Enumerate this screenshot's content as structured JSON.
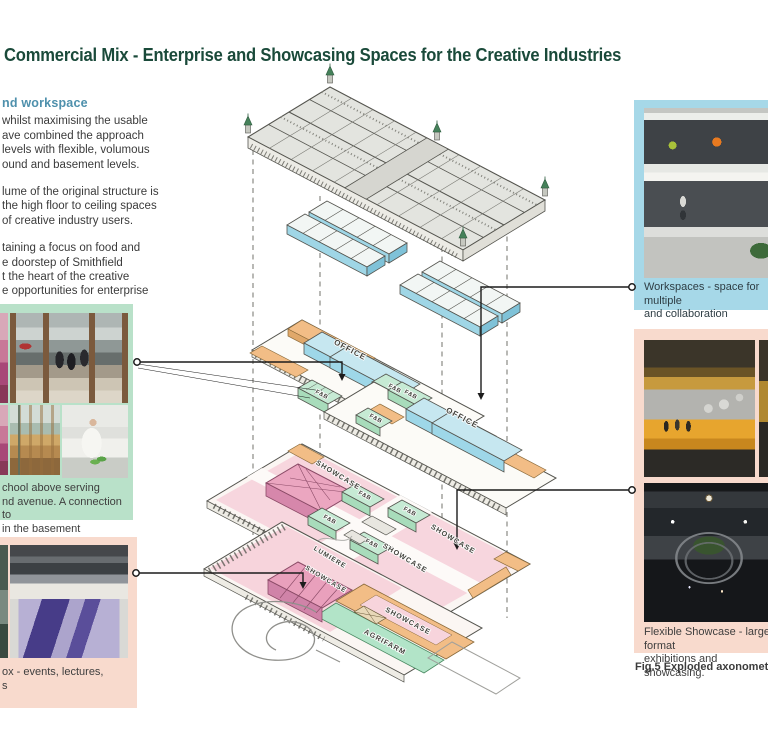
{
  "title": {
    "text": "Commercial Mix - Enterprise and Showcasing Spaces for the Creative Industries",
    "color": "#1a4a3a"
  },
  "left_column": {
    "heading": "nd workspace",
    "heading_color": "#4e90ac",
    "paragraphs": [
      {
        "lines": [
          "whilst maximising the usable",
          "ave combined the approach",
          "levels with flexible, volumous",
          "ound and basement levels."
        ]
      },
      {
        "lines": [
          "lume of the original structure is",
          "the high floor to ceiling spaces",
          "of creative industry users."
        ]
      },
      {
        "lines": [
          "taining a focus on food and",
          "e doorstep of Smithfield",
          "t the heart of the creative",
          "e opportunities for enterprise"
        ]
      }
    ]
  },
  "panels": {
    "food_school": {
      "bg": "#b9e1c9",
      "caption_lines": [
        "chool above serving",
        "nd avenue. A connection to",
        "in the basement"
      ]
    },
    "events_box": {
      "bg": "#f8dacd",
      "caption_lines": [
        "ox - events, lectures,",
        "s"
      ]
    },
    "workspaces": {
      "bg": "#a6d8e8",
      "caption_lines": [
        "Workspaces - space for multiple",
        "and collaboration"
      ]
    },
    "flexible_showcase": {
      "bg": "#f8dacd",
      "caption_lines": [
        "Flexible Showcase - large format",
        "exhibitions and showcasing."
      ]
    }
  },
  "figure_caption": "Fig.5  Exploded axonometric of pre",
  "diagram": {
    "labels": [
      {
        "name": "office-upper",
        "text": "OFFICE"
      },
      {
        "name": "fnb-upper",
        "text": "F&B"
      },
      {
        "name": "fnb-upper-target",
        "text": "F&B"
      },
      {
        "name": "office-lower",
        "text": "OFFICE"
      },
      {
        "name": "fnb-mid-1",
        "text": "F&B"
      },
      {
        "name": "fnb-mid-2",
        "text": "F&B"
      },
      {
        "name": "showcase-ground-1",
        "text": "SHOWCASE"
      },
      {
        "name": "showcase-ground-2",
        "text": "SHOWCASE"
      },
      {
        "name": "showcase-ground-3",
        "text": "SHOWCASE"
      },
      {
        "name": "fnb-ground-1",
        "text": "F&B"
      },
      {
        "name": "fnb-ground-2",
        "text": "F&B"
      },
      {
        "name": "fnb-ground-3",
        "text": "F&B"
      },
      {
        "name": "fnb-ground-4",
        "text": "F&B"
      },
      {
        "name": "lumiere",
        "text": "LUMIERE"
      },
      {
        "name": "showcase-basement-1",
        "text": "SHOWCASE"
      },
      {
        "name": "showcase-basement-2",
        "text": "SHOWCASE"
      },
      {
        "name": "agrifarm",
        "text": "AGRIFARM"
      }
    ]
  },
  "colors": {
    "title_green": "#1a4a3a",
    "heading_teal": "#4e90ac",
    "panel_mint": "#b9e1c9",
    "panel_pink": "#f8dacd",
    "panel_blue": "#a6d8e8",
    "office_blue": "#9ed7e8",
    "fnb_green": "#a8dcbb",
    "showcase_pink": "#f7d4dc",
    "accent_orange": "#f2bd86",
    "venue_dark_pink": "#d687ab",
    "agrifarm_green": "#b2e4c8"
  }
}
